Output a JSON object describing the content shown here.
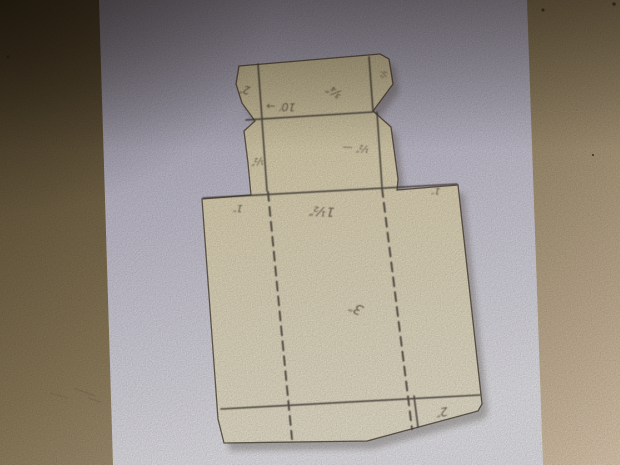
{
  "colors": {
    "surface_dark": "#4e4129",
    "surface_mid": "#94825f",
    "surface_light": "#eed9bd",
    "paper_top": "#aaa5ba",
    "paper_mid": "#cfcbdb",
    "paper_bottom": "#f3f2f7",
    "template_top": "#dbcda4",
    "template_mid": "#eadfbe",
    "template_bottom": "#f5eed8",
    "pencil": "#46403a"
  },
  "annotations": [
    {
      "name": "top-left-tab-measure",
      "text": "2″",
      "x": 245,
      "y": 86,
      "rot": 188,
      "size": 11
    },
    {
      "name": "lid-depth-measure",
      "text": "10′ →",
      "x": 281,
      "y": 103,
      "rot": 182,
      "size": 11
    },
    {
      "name": "lid-flap-measure",
      "text": "¾″",
      "x": 336,
      "y": 88,
      "rot": 210,
      "size": 12
    },
    {
      "name": "right-tab-measure",
      "text": "½",
      "x": 381,
      "y": 74,
      "rot": 95,
      "size": 8
    },
    {
      "name": "mid-left-tab-measure",
      "text": "½″",
      "x": 257,
      "y": 158,
      "rot": 172,
      "size": 10
    },
    {
      "name": "mid-right-measure",
      "text": "½″ —",
      "x": 356,
      "y": 145,
      "rot": 183,
      "size": 10
    },
    {
      "name": "panel-left-measure",
      "text": "1″",
      "x": 238,
      "y": 205,
      "rot": 183,
      "size": 10
    },
    {
      "name": "panel-top-measure",
      "text": "1½″",
      "x": 322,
      "y": 207,
      "rot": 184,
      "size": 13
    },
    {
      "name": "panel-right-measure",
      "text": "1″",
      "x": 436,
      "y": 188,
      "rot": 185,
      "size": 9
    },
    {
      "name": "panel-center-measure",
      "text": "3″",
      "x": 358,
      "y": 304,
      "rot": 205,
      "size": 14
    },
    {
      "name": "bottom-tab-measure",
      "text": "2″",
      "x": 441,
      "y": 408,
      "rot": 170,
      "size": 12
    }
  ],
  "specks": [
    {
      "x": 8,
      "y": 57,
      "r": 1.6
    },
    {
      "x": 543,
      "y": 10,
      "r": 1.6
    },
    {
      "x": 593,
      "y": 155,
      "r": 1.1
    },
    {
      "x": 614,
      "y": 4,
      "r": 1.8
    }
  ],
  "smudges": [
    {
      "x1": 50,
      "y1": 393,
      "x2": 68,
      "y2": 398
    },
    {
      "x1": 74,
      "y1": 388,
      "x2": 95,
      "y2": 396
    },
    {
      "x1": 88,
      "y1": 398,
      "x2": 101,
      "y2": 402
    }
  ]
}
